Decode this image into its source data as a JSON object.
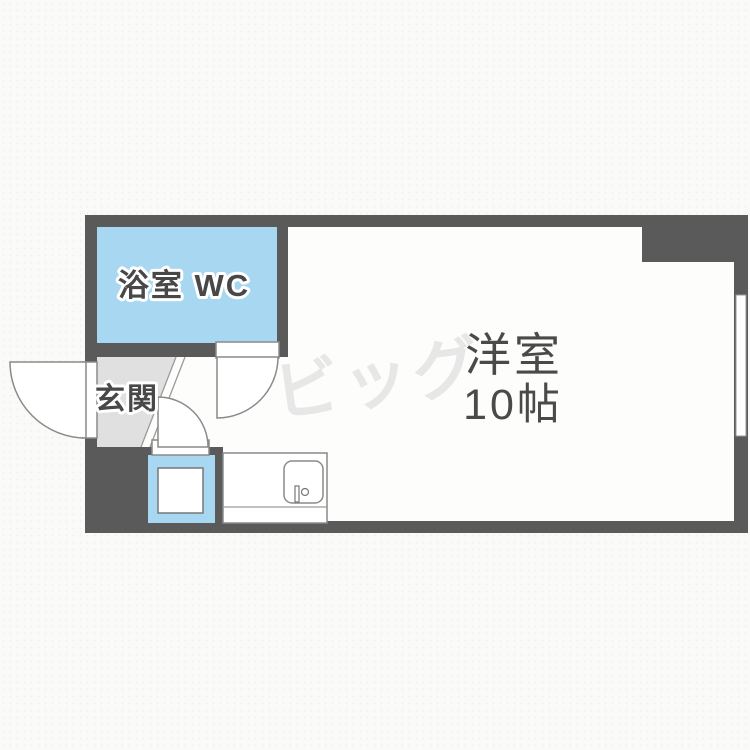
{
  "floorplan": {
    "bathroom_label": "浴室 WC",
    "entrance_label": "玄関",
    "main_room_label": "洋室",
    "main_room_size_label": "10帖",
    "watermark": "ビッグ",
    "colors": {
      "wall": "#5a5a5a",
      "water_blue": "#a8d8f1",
      "entrance_gray": "#e0e0e0",
      "floor_white": "#fdfdfc",
      "label_text": "#484848",
      "watermark_gray": "#e7e7e7",
      "background": "#fafaf8",
      "outline_gray": "#8a8a8a"
    }
  }
}
